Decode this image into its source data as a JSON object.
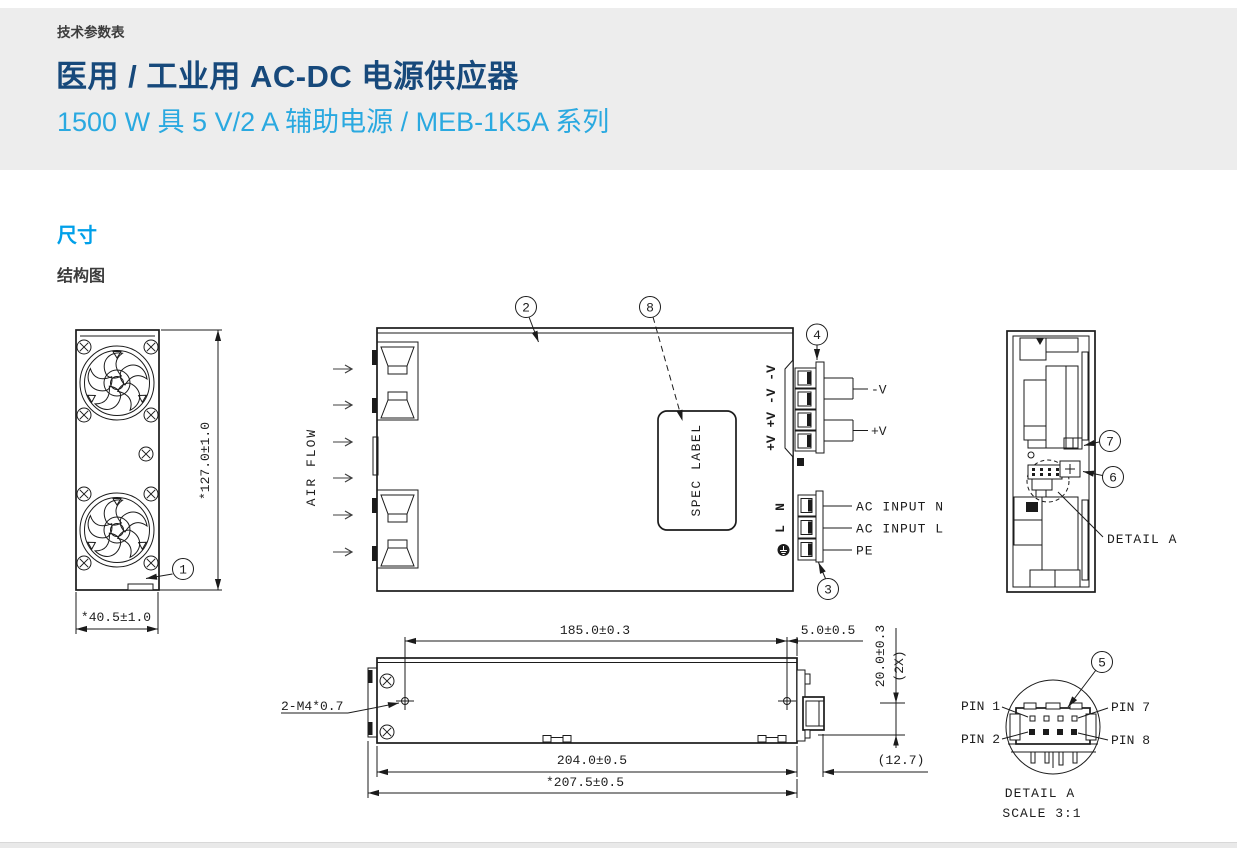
{
  "page": {
    "eyebrow": "技术参数表",
    "title": "医用 / 工业用 AC-DC 电源供应器",
    "subtitle": "1500 W 具 5 V/2 A 辅助电源 / MEB-1K5A 系列",
    "section_heading": "尺寸",
    "subsection_heading": "结构图"
  },
  "colors": {
    "accent_blue": "#00a0e9",
    "title_navy": "#17497b",
    "subtitle_blue": "#2aa9e0",
    "band_gray": "#ededed",
    "line": "#1b1b1b"
  },
  "front_view": {
    "balloon": "1",
    "height_dim": "*127.0±1.0",
    "width_dim": "*40.5±1.0"
  },
  "top_view": {
    "balloon_cover": "2",
    "balloon_spec": "8",
    "balloon_output": "4",
    "balloon_input": "3",
    "air_flow": "AIR FLOW",
    "spec_label": "SPEC LABEL",
    "output_terminals": "+V +V -V -V",
    "neg_label": "-V",
    "pos_label": "+V",
    "n_mark": "N",
    "l_mark": "L",
    "ac_input_n": "AC INPUT N",
    "ac_input_l": "AC INPUT L",
    "pe": "PE"
  },
  "side_view": {
    "balloon_7": "7",
    "balloon_6": "6",
    "detail_label": "DETAIL A"
  },
  "bottom_view": {
    "m4": "2-M4*0.7",
    "d185": "185.0±0.3",
    "d5": "5.0±0.5",
    "d20": "20.0±0.3",
    "d2x": "(2X)",
    "d204": "204.0±0.5",
    "d207": "*207.5±0.5",
    "d127": "(12.7)"
  },
  "detail_a": {
    "balloon": "5",
    "pin1": "PIN 1",
    "pin2": "PIN 2",
    "pin7": "PIN 7",
    "pin8": "PIN 8",
    "title": "DETAIL A",
    "scale": "SCALE 3:1"
  }
}
